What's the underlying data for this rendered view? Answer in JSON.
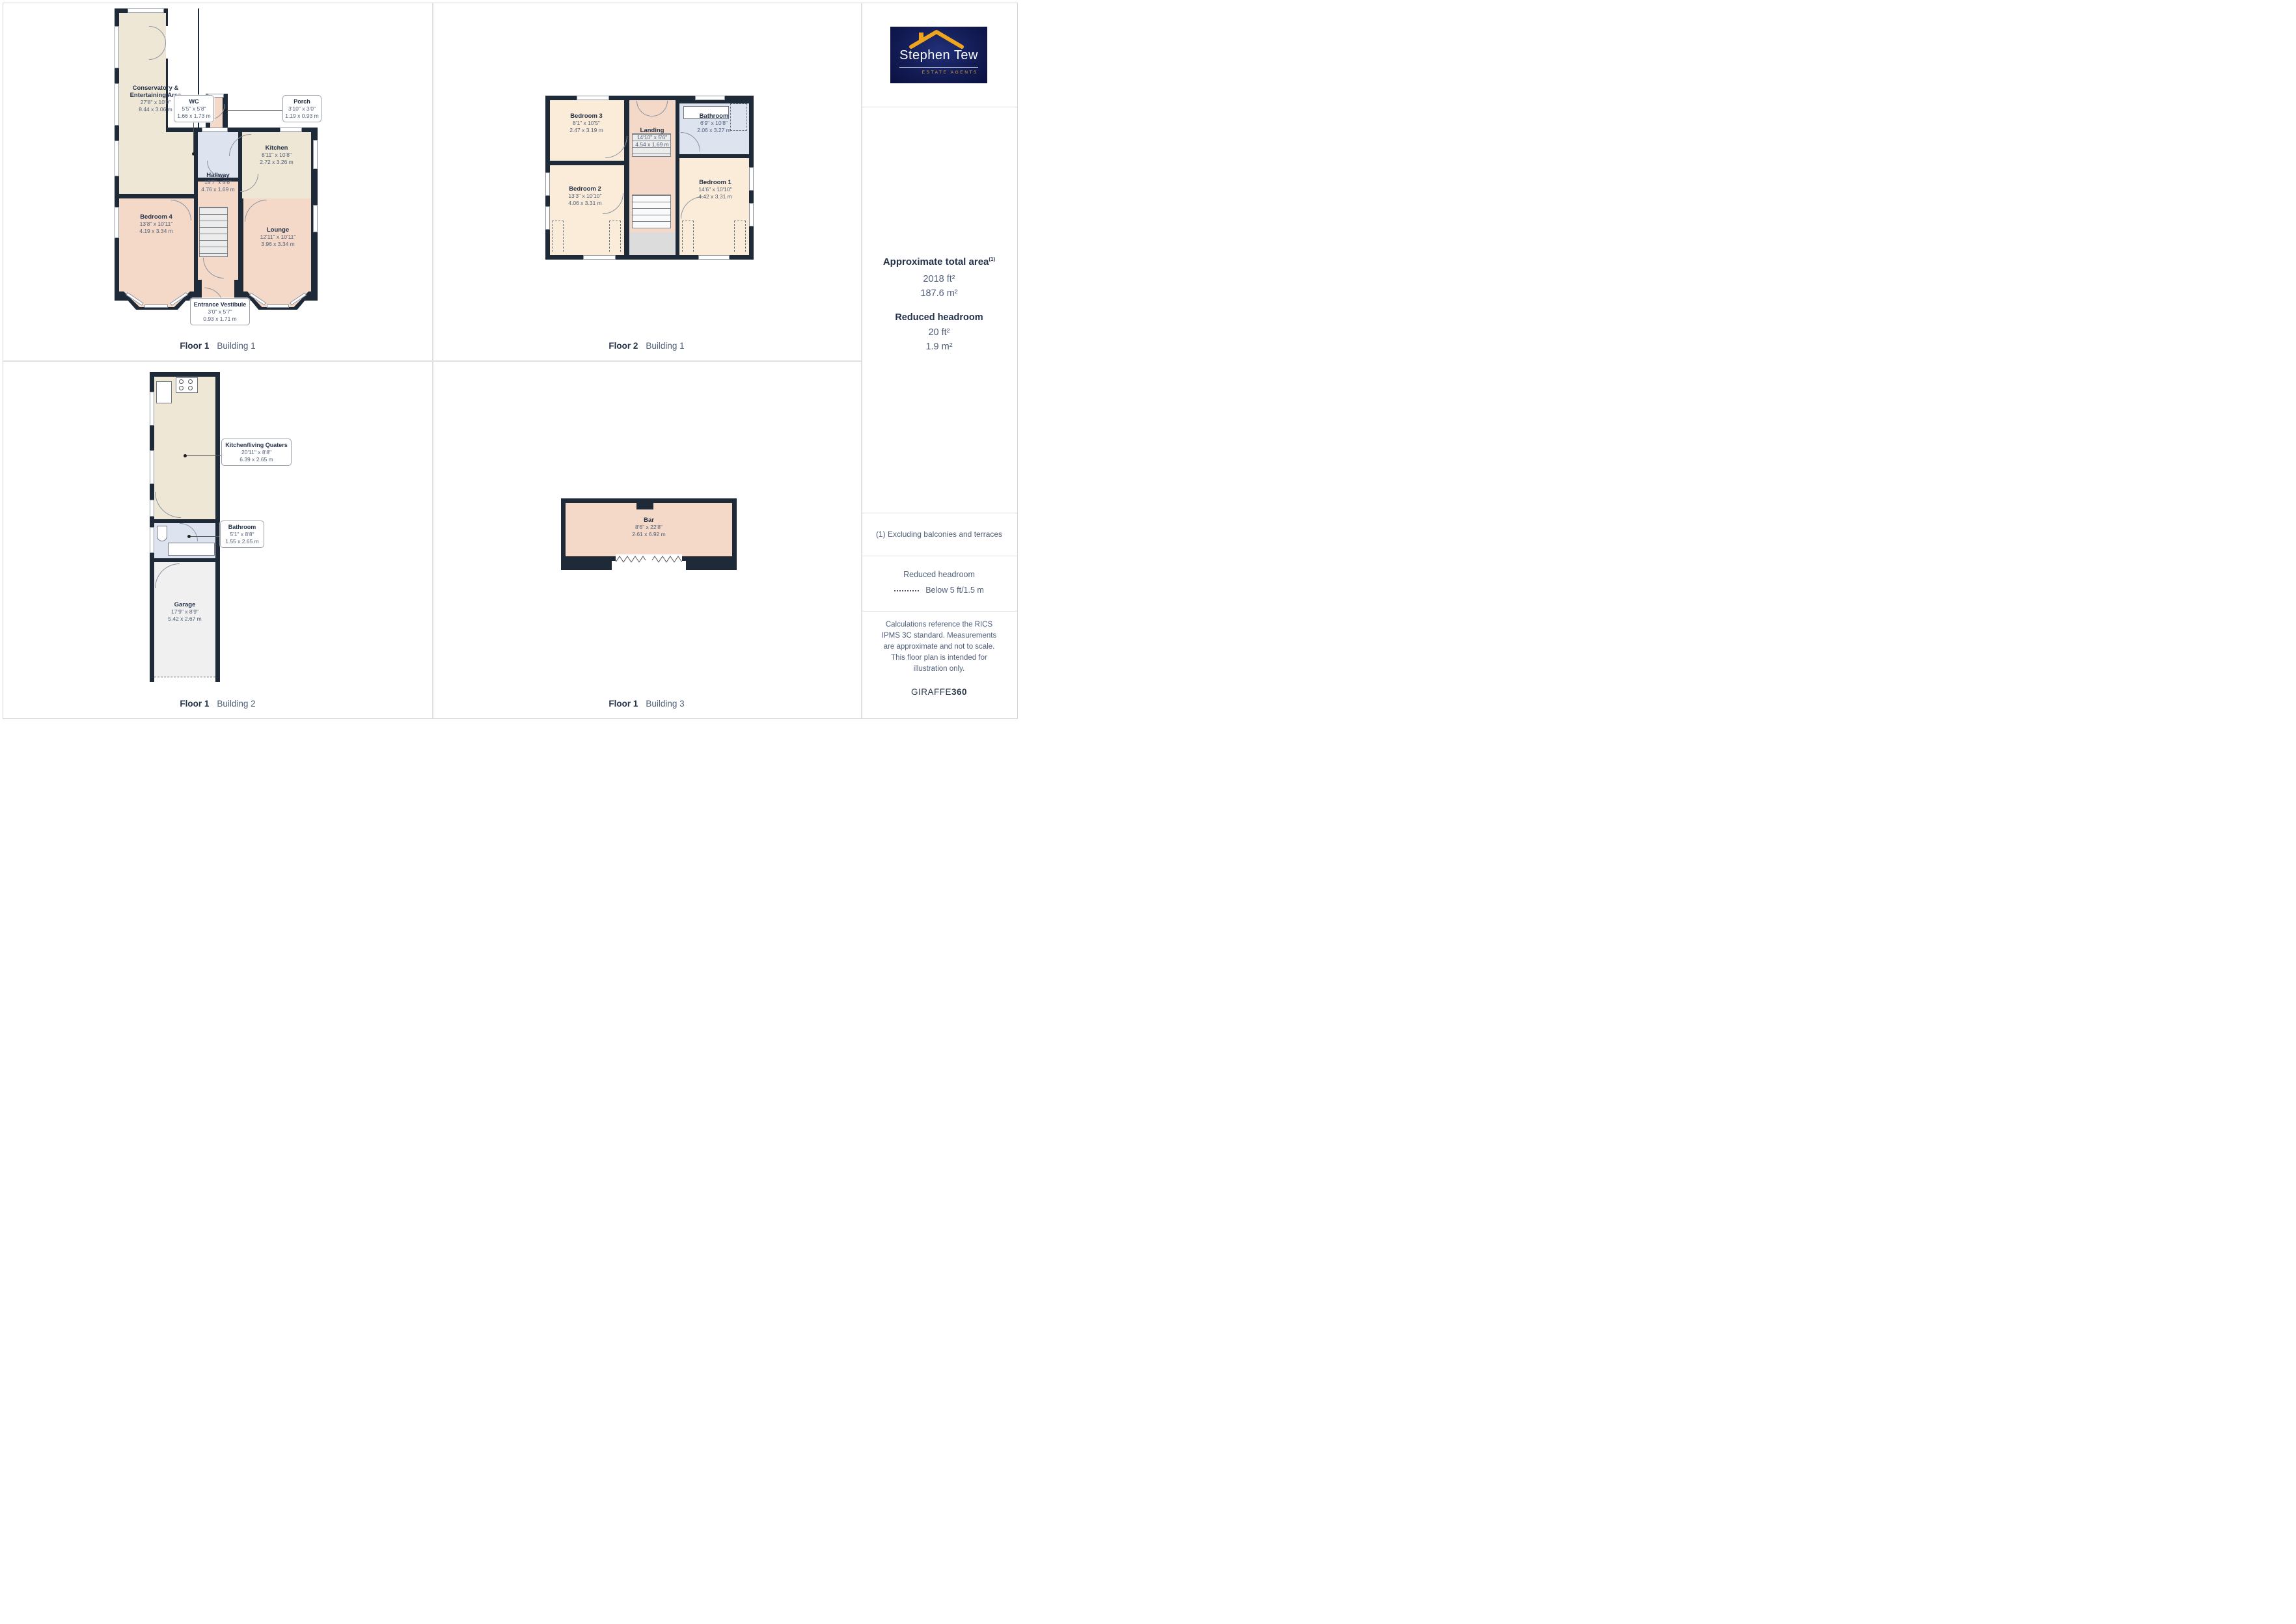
{
  "palette": {
    "wall": "#1f2a38",
    "room_cream": "#eee7d6",
    "room_pink": "#f4d9c8",
    "room_peach": "#fbecd9",
    "room_blue": "#dde3ef",
    "room_grey": "#f0f0f1",
    "text_navy": "#24324a",
    "text_dim": "#51607a",
    "divider": "#e0e0e0",
    "logo_bg": "#131c55",
    "logo_gold": "#f0a51f"
  },
  "plans": {
    "f1b1": {
      "caption": {
        "floor": "Floor 1",
        "building": "Building 1"
      },
      "rooms": {
        "conservatory": {
          "name": "Conservatory & Entertaining Area",
          "dims_ft": "27'8\" x 10'0\"",
          "dims_m": "8.44 x 3.06 m"
        },
        "wc": {
          "name": "WC",
          "dims_ft": "5'5\" x 5'8\"",
          "dims_m": "1.66 x 1.73 m"
        },
        "porch": {
          "name": "Porch",
          "dims_ft": "3'10\" x 3'0\"",
          "dims_m": "1.19 x 0.93 m"
        },
        "kitchen": {
          "name": "Kitchen",
          "dims_ft": "8'11\" x 10'8\"",
          "dims_m": "2.72 x 3.26 m"
        },
        "hallway": {
          "name": "Hallway",
          "dims_ft": "15'7\" x 5'6\"",
          "dims_m": "4.76 x 1.69 m"
        },
        "bedroom4": {
          "name": "Bedroom 4",
          "dims_ft": "13'8\" x 10'11\"",
          "dims_m": "4.19 x 3.34 m"
        },
        "lounge": {
          "name": "Lounge",
          "dims_ft": "12'11\" x 10'11\"",
          "dims_m": "3.96 x 3.34 m"
        },
        "vestibule": {
          "name": "Entrance Vestibule",
          "dims_ft": "3'0\" x 5'7\"",
          "dims_m": "0.93 x 1.71 m"
        }
      }
    },
    "f2b1": {
      "caption": {
        "floor": "Floor 2",
        "building": "Building 1"
      },
      "rooms": {
        "bedroom3": {
          "name": "Bedroom 3",
          "dims_ft": "8'1\" x 10'5\"",
          "dims_m": "2.47 x 3.19 m"
        },
        "landing": {
          "name": "Landing",
          "dims_ft": "14'10\" x 5'6\"",
          "dims_m": "4.54 x 1.69 m"
        },
        "bathroom": {
          "name": "Bathroom",
          "dims_ft": "6'9\" x 10'8\"",
          "dims_m": "2.06 x 3.27 m"
        },
        "bedroom2": {
          "name": "Bedroom 2",
          "dims_ft": "13'3\" x 10'10\"",
          "dims_m": "4.06 x 3.31 m"
        },
        "bedroom1": {
          "name": "Bedroom 1",
          "dims_ft": "14'6\" x 10'10\"",
          "dims_m": "4.42 x 3.31 m"
        }
      }
    },
    "f1b2": {
      "caption": {
        "floor": "Floor 1",
        "building": "Building 2"
      },
      "rooms": {
        "kitchen_living": {
          "name": "Kitchen/living Quaters",
          "dims_ft": "20'11\" x 8'8\"",
          "dims_m": "6.39 x 2.65 m"
        },
        "bathroom": {
          "name": "Bathroom",
          "dims_ft": "5'1\" x 8'8\"",
          "dims_m": "1.55 x 2.65 m"
        },
        "garage": {
          "name": "Garage",
          "dims_ft": "17'9\" x 8'9\"",
          "dims_m": "5.42 x 2.67 m"
        }
      }
    },
    "f1b3": {
      "caption": {
        "floor": "Floor 1",
        "building": "Building 3"
      },
      "rooms": {
        "bar": {
          "name": "Bar",
          "dims_ft": "8'6\" x 22'8\"",
          "dims_m": "2.61 x 6.92 m"
        }
      }
    }
  },
  "sidebar": {
    "logo": {
      "name": "Stephen Tew",
      "tagline": "ESTATE AGENTS"
    },
    "total_area": {
      "title": "Approximate total area",
      "footnote_marker": "(1)",
      "value_ft": "2018 ft²",
      "value_m": "187.6 m²"
    },
    "reduced_headroom": {
      "title": "Reduced headroom",
      "value_ft": "20 ft²",
      "value_m": "1.9 m²"
    },
    "footnote": "(1) Excluding balconies and terraces",
    "legend": {
      "title": "Reduced headroom",
      "label": "Below 5 ft/1.5 m"
    },
    "disclaimer": "Calculations reference the RICS IPMS 3C standard. Measurements are approximate and not to scale. This floor plan is intended for illustration only.",
    "brand": {
      "name": "GIRAFFE",
      "suffix": "360"
    }
  }
}
